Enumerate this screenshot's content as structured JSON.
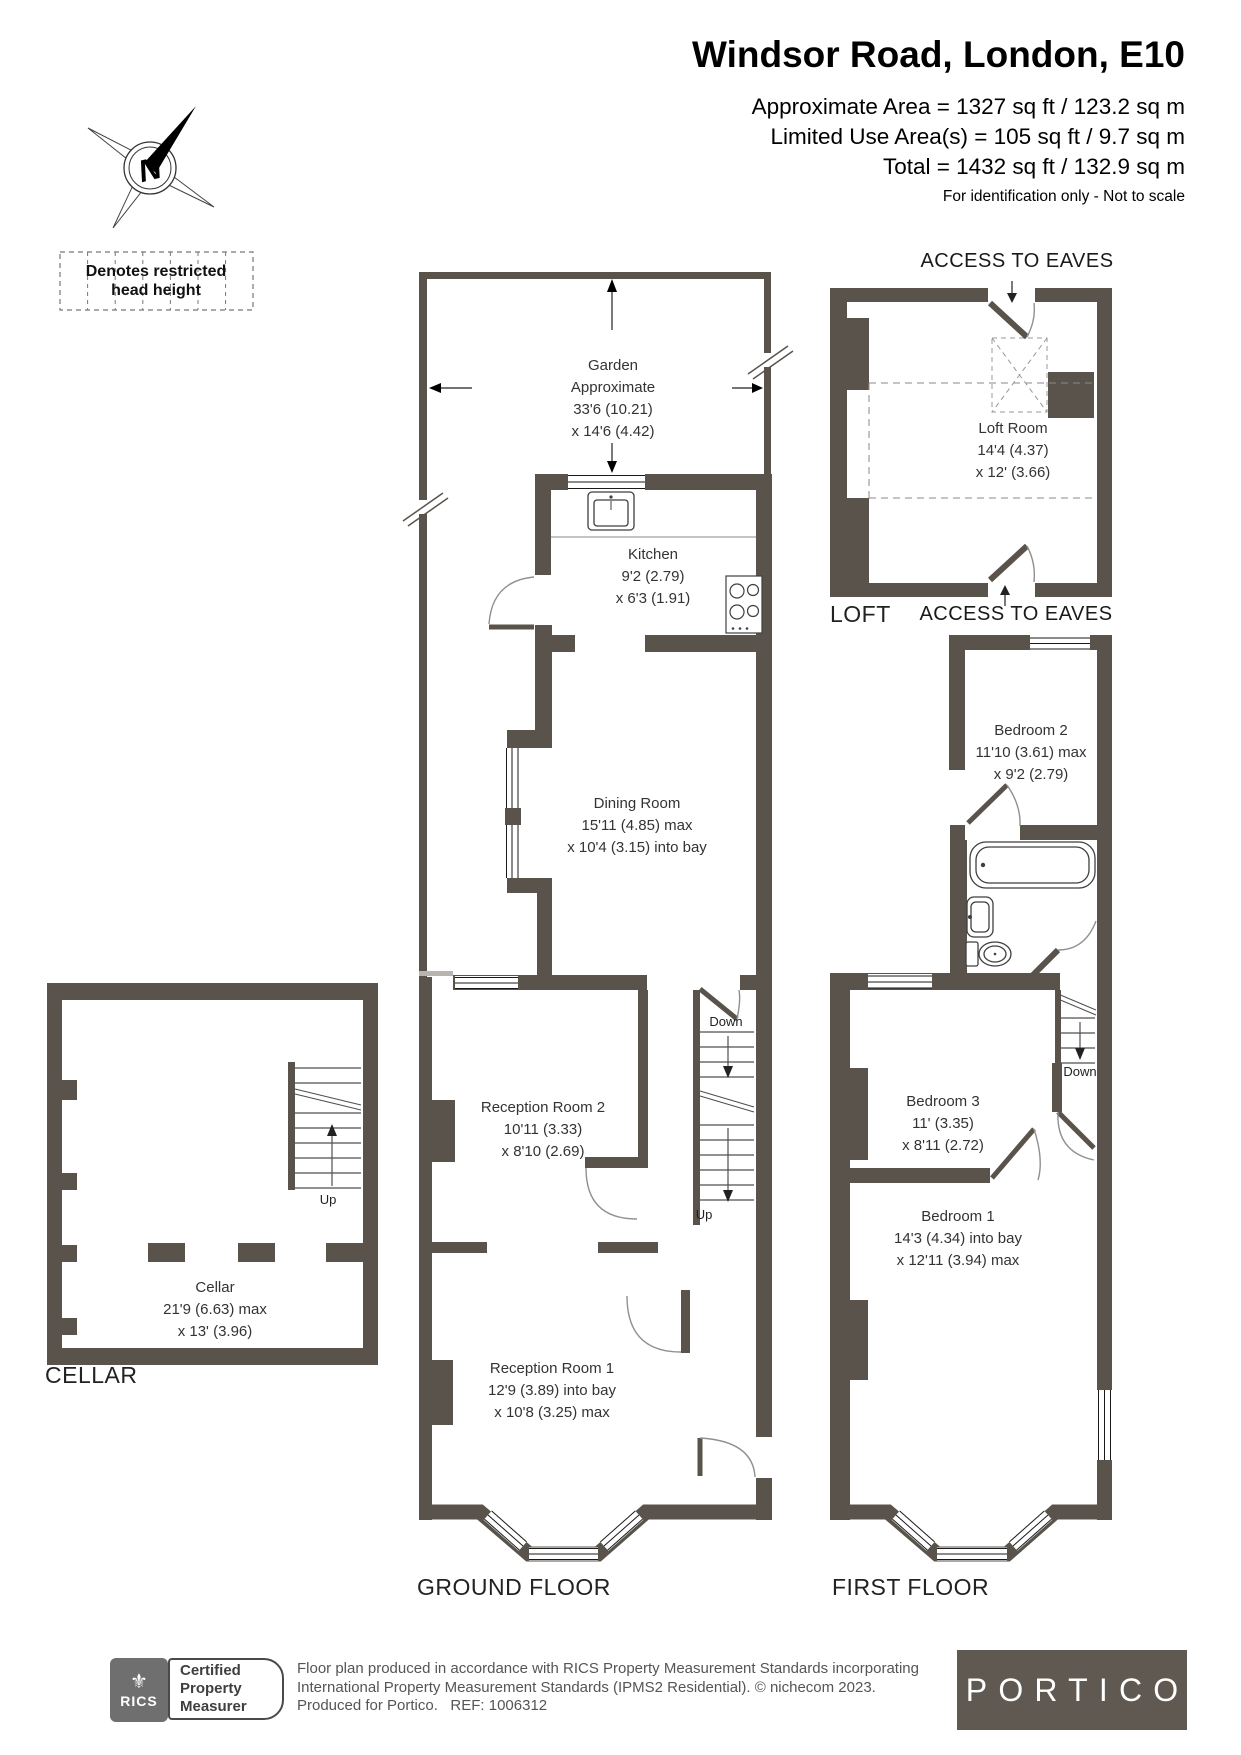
{
  "header": {
    "title": "Windsor Road, London, E10",
    "area_line1": "Approximate Area = 1327 sq ft / 123.2 sq m",
    "area_line2": "Limited Use Area(s) = 105 sq ft / 9.7 sq m",
    "area_line3": "Total = 1432 sq ft / 132.9 sq m",
    "note": "For identification only - Not to scale"
  },
  "compass": {
    "letter": "N"
  },
  "legend": {
    "line1": "Denotes restricted",
    "line2": "head height"
  },
  "labels": {
    "loft": "LOFT",
    "cellar": "CELLAR",
    "ground": "GROUND FLOOR",
    "first": "FIRST FLOOR",
    "access_eaves_top": "ACCESS TO EAVES",
    "access_eaves_bottom": "ACCESS TO EAVES",
    "down": "Down",
    "up": "Up"
  },
  "rooms": {
    "garden": {
      "lines": [
        "Garden",
        "Approximate",
        "33'6 (10.21)",
        "x 14'6 (4.42)"
      ]
    },
    "kitchen": {
      "lines": [
        "Kitchen",
        "9'2 (2.79)",
        "x 6'3 (1.91)"
      ]
    },
    "dining": {
      "lines": [
        "Dining Room",
        "15'11 (4.85) max",
        "x 10'4 (3.15) into bay"
      ]
    },
    "reception2": {
      "lines": [
        "Reception Room 2",
        "10'11 (3.33)",
        "x 8'10 (2.69)"
      ]
    },
    "reception1": {
      "lines": [
        "Reception Room 1",
        "12'9 (3.89) into bay",
        "x 10'8 (3.25) max"
      ]
    },
    "cellar": {
      "lines": [
        "Cellar",
        "21'9 (6.63) max",
        "x 13' (3.96)"
      ]
    },
    "loft_room": {
      "lines": [
        "Loft Room",
        "14'4 (4.37)",
        "x 12' (3.66)"
      ]
    },
    "bedroom2": {
      "lines": [
        "Bedroom 2",
        "11'10 (3.61) max",
        "x 9'2 (2.79)"
      ]
    },
    "bedroom3": {
      "lines": [
        "Bedroom 3",
        "11' (3.35)",
        "x 8'11 (2.72)"
      ]
    },
    "bedroom1": {
      "lines": [
        "Bedroom 1",
        "14'3 (4.34) into bay",
        "x 12'11 (3.94) max"
      ]
    }
  },
  "footer": {
    "rics": "RICS",
    "cert_line1": "Certified",
    "cert_line2": "Property",
    "cert_line3": "Measurer",
    "disclaimer_line1": "Floor plan produced in accordance with RICS Property Measurement Standards incorporating",
    "disclaimer_line2": "International Property Measurement Standards (IPMS2 Residential).  © nichecom 2023.",
    "disclaimer_line3": "Produced for Portico.   REF: 1006312",
    "portico": "PORTICO"
  },
  "colors": {
    "wall": "#59534b",
    "accent_text": "#333333"
  }
}
